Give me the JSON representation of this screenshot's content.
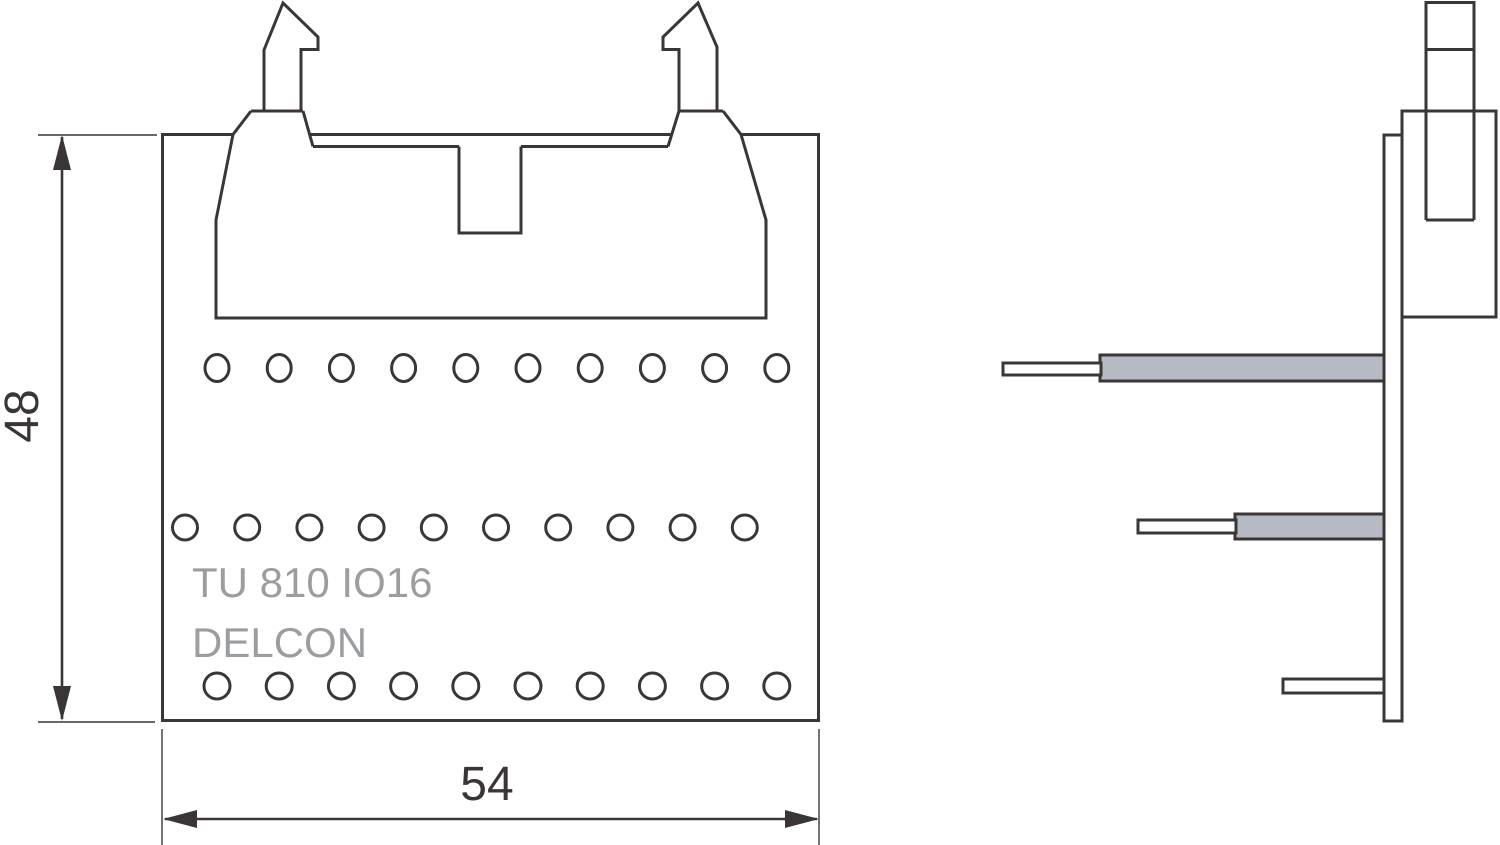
{
  "labels": {
    "part_number": "TU 810 IO16",
    "brand": "DELCON"
  },
  "dimensions": {
    "height_mm": "48",
    "width_mm": "54"
  },
  "front_view": {
    "hole_rows": [
      {
        "y": 368,
        "x_start": 217,
        "spacing": 62.2,
        "count": 10,
        "rx": 12,
        "ry": 13.5
      },
      {
        "y": 527.5,
        "x_start": 185,
        "spacing": 62.2,
        "count": 10,
        "rx": 12.5,
        "ry": 12.5
      },
      {
        "y": 686,
        "x_start": 217,
        "spacing": 62.2,
        "count": 10,
        "rx": 13,
        "ry": 13
      }
    ]
  },
  "side_view": {
    "pin_count": 3
  },
  "colors": {
    "line": "#3a3637",
    "pin_fill": "#b6bac3",
    "brand_text": "#9b9ea1",
    "background": "#ffffff"
  }
}
